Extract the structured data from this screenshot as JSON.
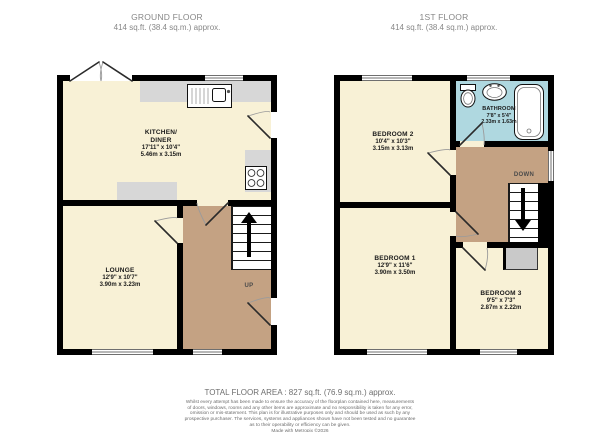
{
  "header": {
    "ground": {
      "title": "GROUND FLOOR",
      "area": "414 sq.ft. (38.4 sq.m.) approx."
    },
    "first": {
      "title": "1ST FLOOR",
      "area": "414 sq.ft. (38.4 sq.m.) approx."
    }
  },
  "rooms": {
    "kitchen": {
      "name1": "KITCHEN/",
      "name2": "DINER",
      "imperial": "17'11\" x 10'4\"",
      "metric": "5.46m x 3.15m"
    },
    "lounge": {
      "name": "LOUNGE",
      "imperial": "12'9\" x 10'7\"",
      "metric": "3.90m x 3.23m"
    },
    "bedroom2": {
      "name": "BEDROOM 2",
      "imperial": "10'4\" x 10'3\"",
      "metric": "3.15m x 3.13m"
    },
    "bedroom1": {
      "name": "BEDROOM 1",
      "imperial": "12'9\" x 11'6\"",
      "metric": "3.90m x 3.50m"
    },
    "bedroom3": {
      "name": "BEDROOM 3",
      "imperial": "9'5\" x 7'3\"",
      "metric": "2.87m x 2.22m"
    },
    "bathroom": {
      "name": "BATHROOM",
      "imperial": "7'8\" x 5'4\"",
      "metric": "2.33m x 1.63m"
    }
  },
  "stairs": {
    "up": "UP",
    "down": "DOWN"
  },
  "footer": {
    "total": "TOTAL FLOOR AREA : 827 sq.ft. (76.9 sq.m.) approx.",
    "disclaimer": [
      "Whilst every attempt has been made to ensure the accuracy of the floorplan contained here, measurements",
      "of doors, windows, rooms and any other items are approximate and no responsibility is taken for any error,",
      "omission or mis-statement. This plan is for illustrative purposes only and should be used as such by any",
      "prospective purchaser. The services, systems and appliances shown have not been tested and no guarantee",
      "as to their operability or efficiency can be given."
    ],
    "credit": "Made with Metropix ©2026"
  },
  "icons": {
    "stairs_up_arrow": "up-arrow",
    "stairs_down_arrow": "down-arrow"
  },
  "colors": {
    "floor_cream": "#f8f1d6",
    "hall_tan": "#c4a283",
    "bathroom_blue": "#afd8e0",
    "wall_black": "#000000",
    "counter_gray": "#d7d7d7",
    "cupboard_gray": "#c9c9c9"
  }
}
